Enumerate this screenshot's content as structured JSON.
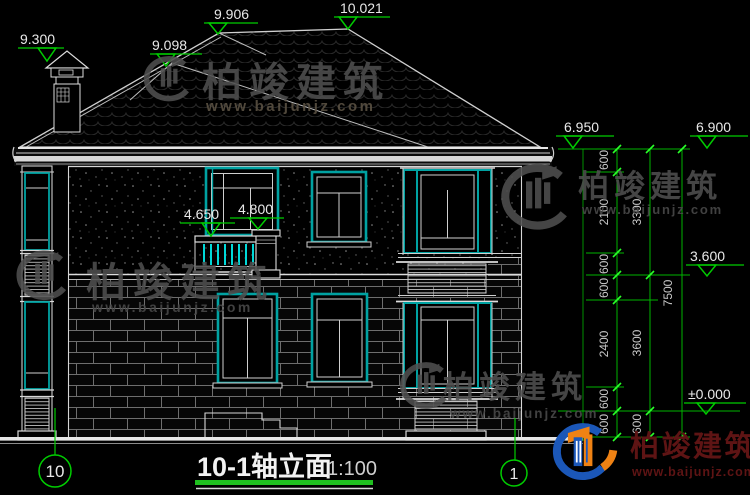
{
  "drawing": {
    "title": "10-1轴立面",
    "scale": "1:100",
    "axis_bubbles": {
      "left": "10",
      "right": "1"
    },
    "elevation_marks": {
      "chimney_top": "9.300",
      "roof_secondary": "9.098",
      "ridge_left": "9.906",
      "ridge_main": "10.021",
      "eave_right": "6.950",
      "eave_far_right": "6.900",
      "balcony_rail": "4.650",
      "balcony_column": "4.800",
      "second_floor": "3.600",
      "ground_level": "±0.000"
    },
    "dimension_columns": {
      "inner": [
        "600",
        "2100",
        "600",
        "600",
        "2400",
        "600",
        "600"
      ],
      "middle": [
        "3300",
        "3600",
        "600"
      ],
      "outer": [
        "7500"
      ]
    }
  },
  "watermark": {
    "brand": "柏竣建筑",
    "url": "www.baijunjz.com"
  },
  "colors": {
    "background": "#000000",
    "line_white": "#e6e6e6",
    "dimension_green": "#00cc00",
    "window_teal": "#00a2a2",
    "baluster_cyan": "#00d8d8",
    "watermark_gray": "#4f4f4f",
    "logo_blue": "#1b57b8",
    "logo_orange": "#ef8214",
    "brand_dark_red": "#5e1414"
  }
}
